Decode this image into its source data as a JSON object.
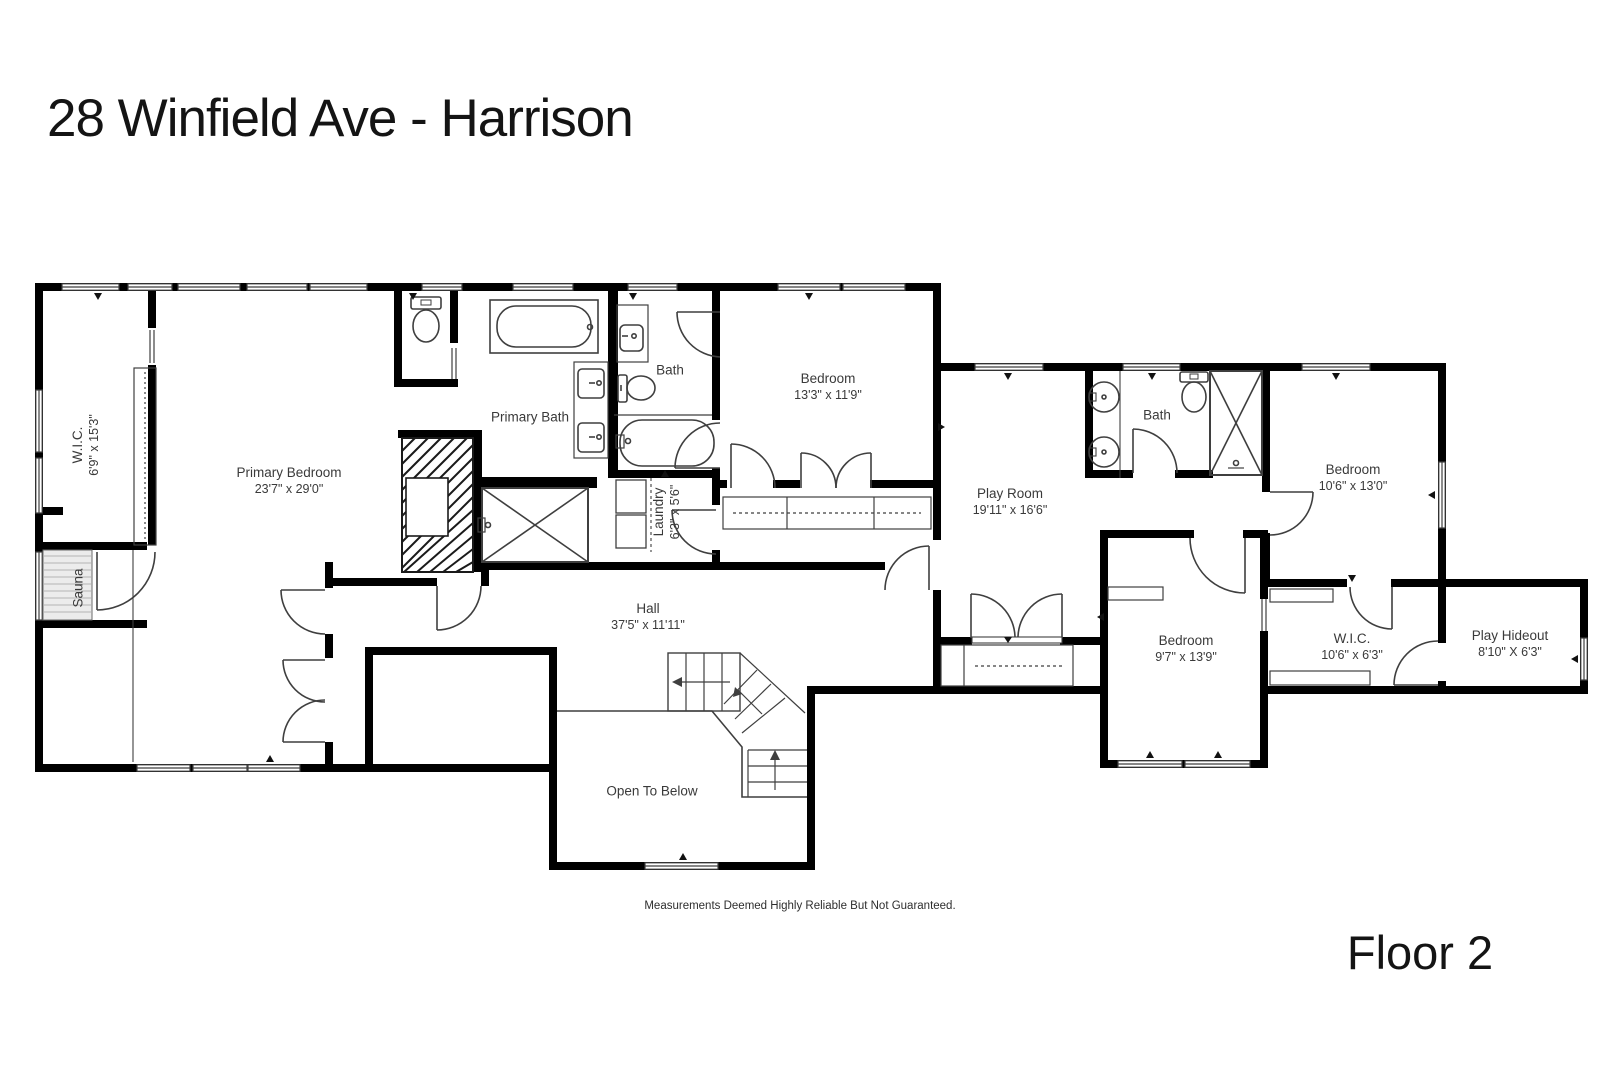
{
  "title": "28 Winfield Ave - Harrison",
  "floor_label": "Floor 2",
  "disclaimer": "Measurements Deemed Highly Reliable But Not Guaranteed.",
  "colors": {
    "wall": "#000000",
    "fixture_line": "#3f3f3f",
    "label_text": "#3a3a3a",
    "hatch_bg": "#ececec"
  },
  "rooms": {
    "wic_left": {
      "name": "W.I.C.",
      "dims": "6'9\" x 15'3\""
    },
    "sauna": {
      "name": "Sauna"
    },
    "primary_bedroom": {
      "name": "Primary Bedroom",
      "dims": "23'7\" x 29'0\""
    },
    "primary_bath": {
      "name": "Primary Bath"
    },
    "bath_left": {
      "name": "Bath"
    },
    "laundry": {
      "name": "Laundry",
      "dims": "6'3\" x 5'6\""
    },
    "bedroom_13": {
      "name": "Bedroom",
      "dims": "13'3\" x 11'9\""
    },
    "hall": {
      "name": "Hall",
      "dims": "37'5\" x 11'11\""
    },
    "open_to_below": {
      "name": "Open To Below"
    },
    "play_room": {
      "name": "Play Room",
      "dims": "19'11\" x 16'6\""
    },
    "bath_right": {
      "name": "Bath"
    },
    "bedroom_10": {
      "name": "Bedroom",
      "dims": "10'6\" x 13'0\""
    },
    "bedroom_9": {
      "name": "Bedroom",
      "dims": "9'7\" x 13'9\""
    },
    "wic_right": {
      "name": "W.I.C.",
      "dims": "10'6\" x 6'3\""
    },
    "play_hideout": {
      "name": "Play Hideout",
      "dims": "8'10\" X 6'3\""
    }
  }
}
